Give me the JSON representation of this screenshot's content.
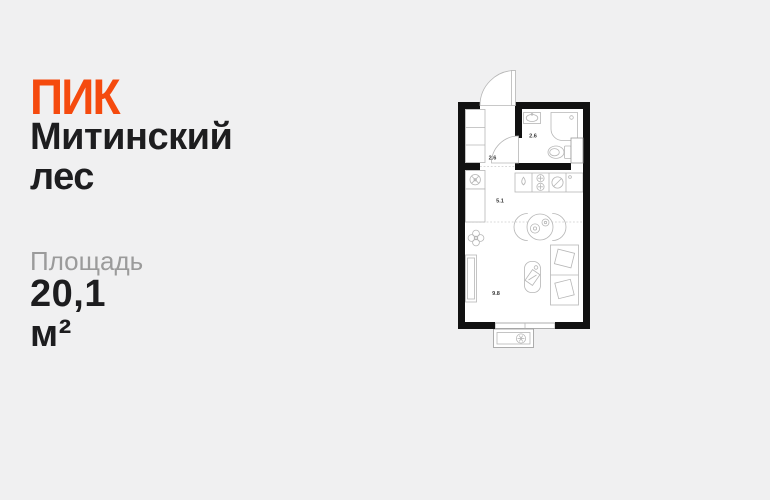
{
  "brand": {
    "logo_text": "ПИК",
    "logo_color": "#f54a0e"
  },
  "listing": {
    "project_name_line1": "Митинский",
    "project_name_line2": "лес",
    "area_label": "Площадь",
    "area_value": "20,1 м²"
  },
  "floor_plan": {
    "type": "studio-apartment-plan",
    "total_area_m2": "20,1",
    "rooms": [
      {
        "name": "hallway",
        "area": "2.6"
      },
      {
        "name": "bathroom",
        "area": "2.6"
      },
      {
        "name": "kitchen",
        "area": "5.1"
      },
      {
        "name": "living-room",
        "area": "9.8"
      }
    ],
    "fixtures": [
      "entrance-door",
      "entry-closet",
      "bathroom-sink",
      "shower",
      "toilet",
      "duct-shaft",
      "bathroom-door",
      "washing-machine",
      "kitchen-cabinet",
      "kitchen-counter",
      "sink-drop-icon",
      "hob-icon",
      "washer-icon",
      "sink-tap-icon",
      "dining-table",
      "chairs",
      "plant",
      "wardrobe",
      "armchair",
      "bed",
      "window",
      "balcony",
      "ac-unit-icon"
    ],
    "colors": {
      "background": "#f0f0f1",
      "wall": "#111111",
      "floor": "#ffffff",
      "furniture_outline": "#b6b6b6",
      "label": "#3a3a3a",
      "title_text": "#1d1d1f",
      "muted_text": "#9b9b9b"
    }
  }
}
